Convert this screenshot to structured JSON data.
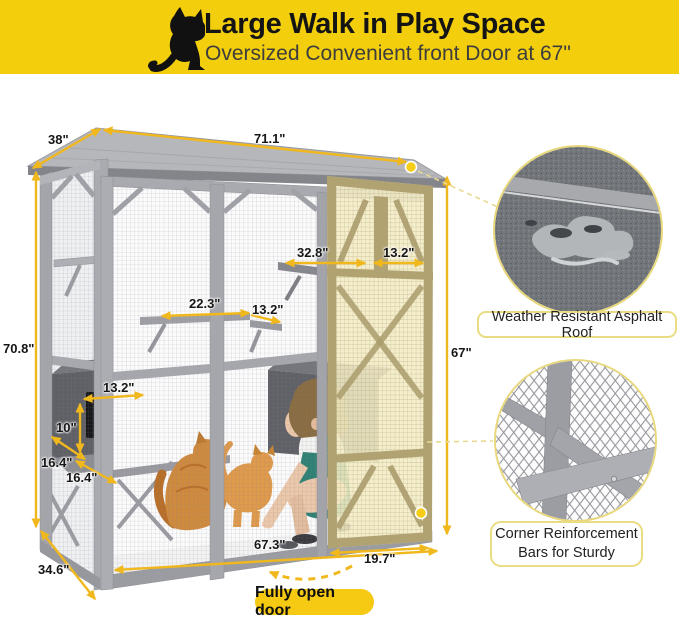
{
  "header": {
    "title": "Large Walk in Play Space",
    "subtitle": "Oversized Convenient front Door at 67\"",
    "icon": "cat-silhouette",
    "bg_color": "#F2CE0D"
  },
  "dimensions": {
    "roof_depth": "38\"",
    "roof_width": "71.1\"",
    "total_height": "70.8\"",
    "upper_shelf_span": "32.8\"",
    "upper_shelf_door": "13.2\"",
    "mid_shelf_span": "22.3\"",
    "mid_shelf_small": "13.2\"",
    "house_width": "13.2\"",
    "house_height": "10\"",
    "house_depth_a": "16.4\"",
    "house_depth_b": "16.4\"",
    "door_height": "67\"",
    "base_width": "67.3\"",
    "door_width": "19.7\"",
    "base_depth": "34.6\""
  },
  "callouts": {
    "roof_label": "Weather Resistant Asphalt Roof",
    "corner_line1": "Corner Reinforcement",
    "corner_line2": "Bars for Sturdy"
  },
  "door_note": {
    "label": "Fully open door"
  },
  "colors": {
    "banner_yellow": "#F2CE0D",
    "arrow_gold": "#F0B81C",
    "badge_yellow": "#F6C913",
    "door_highlight": "#F3ECC6",
    "frame_gray": "#9FA0A6",
    "label_border": "#EADC83"
  }
}
